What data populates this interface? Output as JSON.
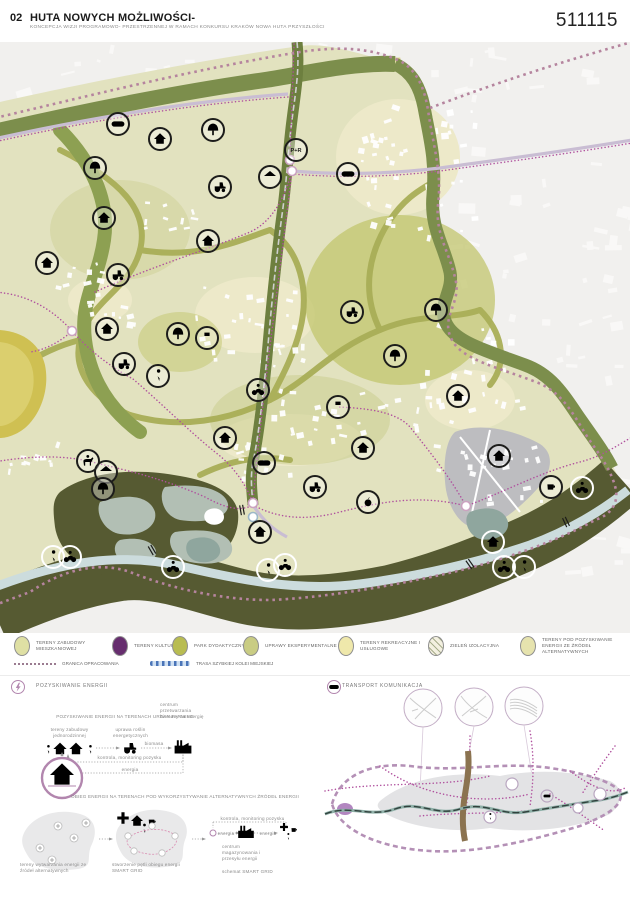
{
  "header": {
    "number": "02",
    "title": "HUTA NOWYCH MOŻLIWOŚCI-",
    "subtitle": "KONCEPCJA WIZJI PROGRAMOWO- PRZESTRZENNEJ W RAMACH KONKURSU KRAKÓW NOWA HUTA PRZYSZŁOŚCI",
    "entry_code": "511115"
  },
  "legend": {
    "items": [
      {
        "label": "TERENY ZABUDOWY MIESZKANIOWEJ",
        "color": "#dfe0a4",
        "hatch": false
      },
      {
        "label": "TERENY KULTURY",
        "color": "#662d6e",
        "hatch": false
      },
      {
        "label": "PARK DYDAKTYCZNY",
        "color": "#b8bc51",
        "hatch": false
      },
      {
        "label": "UPRAWY EKSPERYMENTALNE",
        "color": "#c9cc83",
        "hatch": false
      },
      {
        "label": "TERENY REKREACYJNE I USŁUGOWE",
        "color": "#efe8ab",
        "hatch": false
      },
      {
        "label": "ZIELEŃ IZOLACYJNA",
        "color": "#f3f0e0",
        "hatch": true
      },
      {
        "label": "TERENY POD POZYSKIWANIE ENERGII ZE ŹRÓDEŁ ALTERNATYWNYCH",
        "color": "#e6e3ae",
        "hatch": false
      }
    ],
    "line_items": [
      {
        "label": "GRANICA OPRACOWANIA"
      },
      {
        "label": "TRASA SZYBKIEJ KOLEI MIEJSKIEJ"
      }
    ]
  },
  "map": {
    "pr_label": "P+R",
    "colors": {
      "green_belt": "#7c8e4c",
      "dark_valley": "#565a32",
      "interior": "#e2e2bf",
      "olive_path": "#a9ae57",
      "river": "#ccdcdd",
      "boundary": "#b5849e",
      "route_dotted": "#b0519e",
      "road": "#c9bdd3",
      "mustard": "#cfc052",
      "sage": "#b2bfb4",
      "gray_zone": "#bdbdc0",
      "accent": "#b286ae"
    },
    "icons": [
      [
        "tree",
        95,
        126,
        "l"
      ],
      [
        "tree",
        213,
        88,
        "l"
      ],
      [
        "house",
        160,
        97,
        "l"
      ],
      [
        "bus",
        118,
        82,
        "l"
      ],
      [
        "house",
        104,
        176,
        "l"
      ],
      [
        "house",
        208,
        199,
        "l"
      ],
      [
        "pr",
        296,
        108,
        "l"
      ],
      [
        "gazebo",
        270,
        135,
        "l"
      ],
      [
        "tractor",
        220,
        145,
        "l"
      ],
      [
        "bus",
        348,
        132,
        "l"
      ],
      [
        "house",
        47,
        221,
        "l"
      ],
      [
        "tractor",
        118,
        233,
        "l"
      ],
      [
        "house",
        107,
        287,
        "l"
      ],
      [
        "tree",
        178,
        292,
        "l"
      ],
      [
        "photo",
        207,
        296,
        "l"
      ],
      [
        "tractor",
        124,
        322,
        "l"
      ],
      [
        "walk",
        158,
        334,
        "l"
      ],
      [
        "bike",
        258,
        348,
        "l"
      ],
      [
        "tree",
        395,
        314,
        "l"
      ],
      [
        "photo",
        338,
        365,
        "l"
      ],
      [
        "tractor",
        352,
        270,
        "l"
      ],
      [
        "tree",
        436,
        268,
        "l"
      ],
      [
        "house",
        225,
        396,
        "l"
      ],
      [
        "house",
        363,
        406,
        "l"
      ],
      [
        "bus",
        264,
        421,
        "l"
      ],
      [
        "tractor",
        315,
        445,
        "l"
      ],
      [
        "house",
        458,
        354,
        "l"
      ],
      [
        "house",
        499,
        414,
        "l"
      ],
      [
        "coffee",
        551,
        445,
        "l"
      ],
      [
        "horse",
        88,
        419,
        "l"
      ],
      [
        "gazebo",
        106,
        430,
        "l"
      ],
      [
        "tree",
        103,
        447,
        "l"
      ],
      [
        "house",
        260,
        490,
        "l"
      ],
      [
        "apple",
        368,
        460,
        "l"
      ],
      [
        "walk",
        53,
        515,
        "d"
      ],
      [
        "bike",
        70,
        515,
        "d"
      ],
      [
        "bike",
        173,
        525,
        "d"
      ],
      [
        "walk",
        268,
        528,
        "d"
      ],
      [
        "bike",
        285,
        523,
        "d"
      ],
      [
        "house",
        493,
        500,
        "d"
      ],
      [
        "bike",
        582,
        446,
        "d"
      ],
      [
        "bike",
        504,
        525,
        "d"
      ],
      [
        "walk",
        524,
        525,
        "d"
      ]
    ],
    "nodes": [
      [
        290,
        118
      ],
      [
        292,
        129
      ],
      [
        72,
        289
      ],
      [
        253,
        461
      ],
      [
        253,
        475
      ],
      [
        466,
        464
      ]
    ]
  },
  "energy": {
    "section_title": "POZYSKIWANIE ENERGII",
    "farming": {
      "title": "POZYSKIWANIE ENERGII NA TERENACH URBAN FARMING",
      "node1": "tereny zabudowy jednorodzinnej",
      "node2": "uprawa roślin energetycznych",
      "node3": "centrum przetwarzania biomasy na energię",
      "flow_biomass": "biomasa",
      "flow_control": "kontrola, monitoring pozysku",
      "flow_energy": "energia"
    },
    "grid": {
      "title": "OBIEG ENERGII NA TERENACH POD WYKORZYSTYWANIE ALTERNATYWNYCH ŹRÓDEŁ ENERGII",
      "stage1": "tereny wytwarzania energii ze źródeł alternatywnych",
      "stage2": "stworzenie pętli obiegu energii SMART GRID",
      "stage3": "schemat SMART GRID",
      "flow_control": "kontrola, monitoring pozysku",
      "flow_energy_in": "energia",
      "flow_energy_out": "energia",
      "center_label": "centrum magazynowania i przesyłu energii"
    }
  },
  "transport": {
    "section_title": "TRANSPORT KOMUNIKACJA"
  }
}
